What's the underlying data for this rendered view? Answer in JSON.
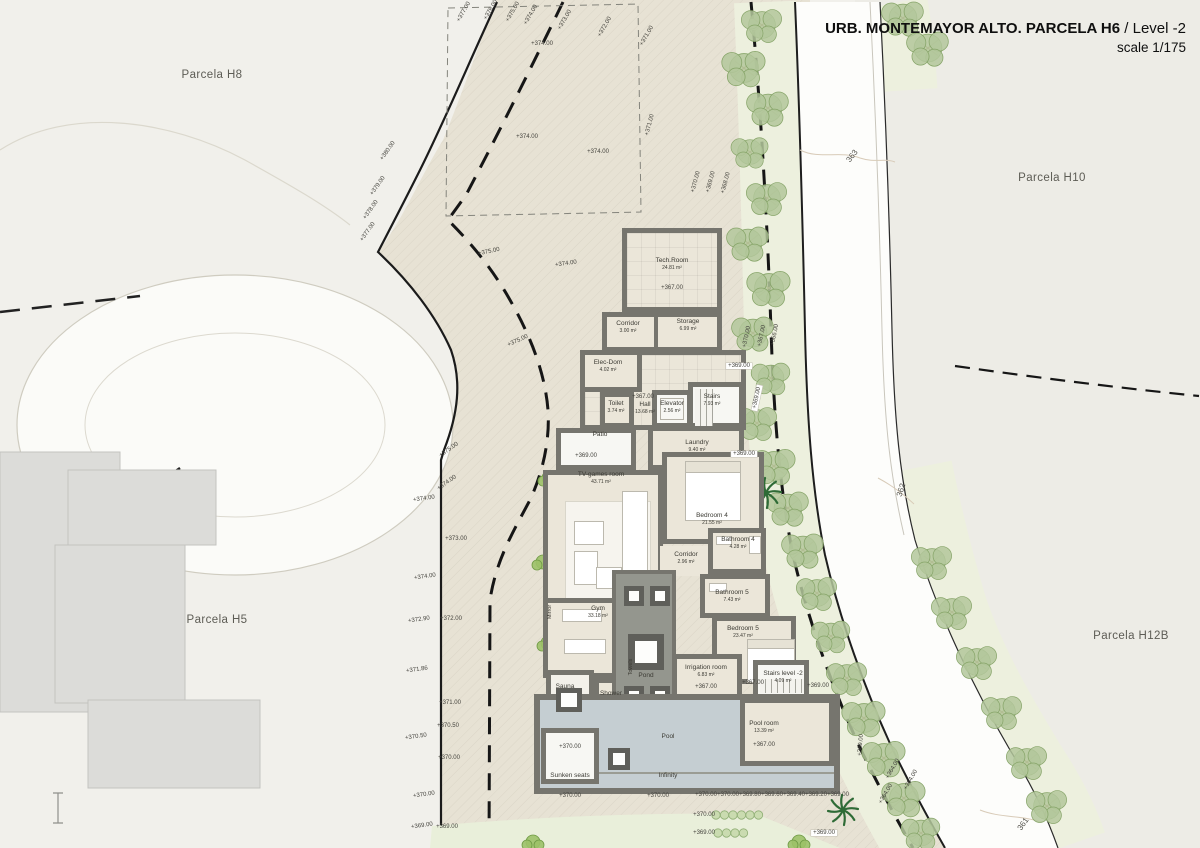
{
  "title": {
    "main": "URB. MONTEMAYOR ALTO. PARCELA H6",
    "sep": " / ",
    "level": "Level -2",
    "scale": "scale 1/175"
  },
  "parcels": [
    {
      "label": "Parcela H8",
      "x": 212,
      "y": 75
    },
    {
      "label": "Parcela H10",
      "x": 1052,
      "y": 178
    },
    {
      "label": "Parcela H5",
      "x": 217,
      "y": 620
    },
    {
      "label": "Parcela H12B",
      "x": 1131,
      "y": 636
    }
  ],
  "contours": [
    {
      "label": "363",
      "x": 852,
      "y": 156,
      "r": -52
    },
    {
      "label": "362",
      "x": 901,
      "y": 490,
      "r": -72
    },
    {
      "label": "361",
      "x": 1023,
      "y": 824,
      "r": -55
    }
  ],
  "rooms": [
    {
      "name": "Tech.Room",
      "area": "24.81 m²",
      "x": 672,
      "y": 264
    },
    {
      "name": "Corridor",
      "area": "3.00 m²",
      "x": 628,
      "y": 327
    },
    {
      "name": "Storage",
      "area": "6.99 m²",
      "x": 688,
      "y": 325
    },
    {
      "name": "Elec-Dom",
      "area": "4.02 m²",
      "x": 608,
      "y": 366
    },
    {
      "name": "Elevator",
      "area": "2.56 m²",
      "x": 672,
      "y": 407
    },
    {
      "name": "Toilet",
      "area": "3.74 m²",
      "x": 616,
      "y": 407
    },
    {
      "name": "Hall",
      "area": "13.68 m²",
      "x": 645,
      "y": 408
    },
    {
      "name": "Stairs",
      "area": "7.93 m²",
      "x": 712,
      "y": 400
    },
    {
      "name": "Laundry",
      "area": "9.40 m²",
      "x": 697,
      "y": 446
    },
    {
      "name": "Patio",
      "area": "",
      "x": 600,
      "y": 435
    },
    {
      "name": "TV-games room",
      "area": "43.71 m²",
      "x": 601,
      "y": 478
    },
    {
      "name": "Bedroom 4",
      "area": "21.55 m²",
      "x": 712,
      "y": 519
    },
    {
      "name": "Bathroom 4",
      "area": "4.28 m²",
      "x": 738,
      "y": 543
    },
    {
      "name": "Corridor",
      "area": "2.96 m²",
      "x": 686,
      "y": 558
    },
    {
      "name": "Bathroom 5",
      "area": "7.43 m²",
      "x": 732,
      "y": 596
    },
    {
      "name": "Bedroom 5",
      "area": "23.47 m²",
      "x": 743,
      "y": 632
    },
    {
      "name": "Gym",
      "area": "33.18 m²",
      "x": 598,
      "y": 612
    },
    {
      "name": "Sauna",
      "area": "",
      "x": 565,
      "y": 687
    },
    {
      "name": "Shower",
      "area": "",
      "x": 611,
      "y": 694
    },
    {
      "name": "Pond",
      "area": "",
      "x": 646,
      "y": 676
    },
    {
      "name": "Irrigation room",
      "area": "6.83 m²",
      "x": 706,
      "y": 671
    },
    {
      "name": "Stairs level -2",
      "area": "4.09 m²",
      "x": 783,
      "y": 677
    },
    {
      "name": "Pool",
      "area": "",
      "x": 668,
      "y": 737
    },
    {
      "name": "Pool room",
      "area": "13.39 m²",
      "x": 764,
      "y": 727
    },
    {
      "name": "Sunken seats",
      "area": "",
      "x": 570,
      "y": 776
    },
    {
      "name": "Infinity",
      "area": "",
      "x": 668,
      "y": 776
    }
  ],
  "vertical_labels": [
    {
      "t": "Mirror",
      "x": 550,
      "y": 612
    },
    {
      "t": "Towels",
      "x": 631,
      "y": 667
    }
  ],
  "elevations": [
    {
      "t": "+380.00",
      "x": 388,
      "y": 151,
      "r": -55
    },
    {
      "t": "+379.00",
      "x": 378,
      "y": 186,
      "r": -55
    },
    {
      "t": "+378.00",
      "x": 371,
      "y": 210,
      "r": -55
    },
    {
      "t": "+377.00",
      "x": 368,
      "y": 232,
      "r": -55
    },
    {
      "t": "+377.00",
      "x": 464,
      "y": 12,
      "r": -60
    },
    {
      "t": "+376.00",
      "x": 491,
      "y": 10,
      "r": -60
    },
    {
      "t": "+375.00",
      "x": 513,
      "y": 12,
      "r": -60
    },
    {
      "t": "+374.00",
      "x": 531,
      "y": 15,
      "r": -60
    },
    {
      "t": "+373.00",
      "x": 565,
      "y": 20,
      "r": -60
    },
    {
      "t": "+372.00",
      "x": 605,
      "y": 27,
      "r": -60
    },
    {
      "t": "+371.00",
      "x": 647,
      "y": 36,
      "r": -60
    },
    {
      "t": "+374.00",
      "x": 542,
      "y": 44,
      "r": 0
    },
    {
      "t": "+374.00",
      "x": 527,
      "y": 137,
      "r": 0
    },
    {
      "t": "+374.00",
      "x": 598,
      "y": 152,
      "r": 0
    },
    {
      "t": "+371.00",
      "x": 650,
      "y": 125,
      "r": -75
    },
    {
      "t": "+370.00",
      "x": 696,
      "y": 182,
      "r": -75
    },
    {
      "t": "+369.00",
      "x": 711,
      "y": 182,
      "r": -75
    },
    {
      "t": "+368.00",
      "x": 726,
      "y": 183,
      "r": -75
    },
    {
      "t": "+375.00",
      "x": 489,
      "y": 252,
      "r": -12
    },
    {
      "t": "+374.00",
      "x": 566,
      "y": 264,
      "r": -8
    },
    {
      "t": "+375.00",
      "x": 518,
      "y": 341,
      "r": -25
    },
    {
      "t": "+375.00",
      "x": 449,
      "y": 450,
      "r": -35
    },
    {
      "t": "+374.00",
      "x": 447,
      "y": 483,
      "r": -35
    },
    {
      "t": "+374.00",
      "x": 424,
      "y": 499,
      "r": -8
    },
    {
      "t": "+374.00",
      "x": 425,
      "y": 577,
      "r": -8
    },
    {
      "t": "+372.90",
      "x": 419,
      "y": 620,
      "r": -8
    },
    {
      "t": "+371.86",
      "x": 417,
      "y": 670,
      "r": -8
    },
    {
      "t": "+370.50",
      "x": 416,
      "y": 737,
      "r": -8
    },
    {
      "t": "+370.00",
      "x": 424,
      "y": 795,
      "r": -8
    },
    {
      "t": "+369.00",
      "x": 422,
      "y": 826,
      "r": -8
    },
    {
      "t": "+373.00",
      "x": 456,
      "y": 539,
      "r": 0
    },
    {
      "t": "+372.00",
      "x": 451,
      "y": 619,
      "r": 0
    },
    {
      "t": "+371.00",
      "x": 450,
      "y": 703,
      "r": 0
    },
    {
      "t": "+370.50",
      "x": 448,
      "y": 726,
      "r": 0
    },
    {
      "t": "+370.00",
      "x": 449,
      "y": 758,
      "r": 0
    },
    {
      "t": "+369.00",
      "x": 447,
      "y": 827,
      "r": 0
    },
    {
      "t": "+370.00",
      "x": 747,
      "y": 337,
      "r": -78
    },
    {
      "t": "+367.00",
      "x": 762,
      "y": 336,
      "r": -78
    },
    {
      "t": "+366.00",
      "x": 775,
      "y": 335,
      "r": -78
    },
    {
      "t": "+369.00",
      "x": 757,
      "y": 398,
      "r": -78,
      "box": true
    },
    {
      "t": "+369.00",
      "x": 739,
      "y": 366,
      "r": 0,
      "box": true
    },
    {
      "t": "+369.00",
      "x": 744,
      "y": 454,
      "r": 0,
      "box": true
    },
    {
      "t": "+367.00",
      "x": 672,
      "y": 288,
      "r": 0
    },
    {
      "t": "+367.00",
      "x": 643,
      "y": 397,
      "r": 0
    },
    {
      "t": "+369.00",
      "x": 586,
      "y": 456,
      "r": 0
    },
    {
      "t": "+367.00",
      "x": 706,
      "y": 687,
      "r": 0
    },
    {
      "t": "+367.00",
      "x": 753,
      "y": 683,
      "r": 0
    },
    {
      "t": "+369.00",
      "x": 818,
      "y": 686,
      "r": 0
    },
    {
      "t": "+367.00",
      "x": 764,
      "y": 745,
      "r": 0
    },
    {
      "t": "+370.00",
      "x": 570,
      "y": 747,
      "r": 0
    },
    {
      "t": "+369.00",
      "x": 861,
      "y": 745,
      "r": -85
    },
    {
      "t": "+370.00",
      "x": 570,
      "y": 796,
      "r": 0
    },
    {
      "t": "+370.00",
      "x": 658,
      "y": 796,
      "r": 0
    },
    {
      "t": "+370.00",
      "x": 706,
      "y": 795,
      "r": 0
    },
    {
      "t": "+370.00",
      "x": 728,
      "y": 795,
      "r": 0
    },
    {
      "t": "+369.80",
      "x": 750,
      "y": 795,
      "r": 0
    },
    {
      "t": "+369.60",
      "x": 772,
      "y": 795,
      "r": 0
    },
    {
      "t": "+369.40",
      "x": 794,
      "y": 795,
      "r": 0
    },
    {
      "t": "+369.20",
      "x": 816,
      "y": 795,
      "r": 0
    },
    {
      "t": "+369.00",
      "x": 838,
      "y": 795,
      "r": 0
    },
    {
      "t": "+370.00",
      "x": 704,
      "y": 815,
      "r": 0
    },
    {
      "t": "+369.00",
      "x": 704,
      "y": 833,
      "r": 0
    },
    {
      "t": "+369.00",
      "x": 824,
      "y": 833,
      "r": 0,
      "box": true
    },
    {
      "t": "+364.00",
      "x": 893,
      "y": 769,
      "r": -60
    },
    {
      "t": "+364.00",
      "x": 911,
      "y": 780,
      "r": -60
    },
    {
      "t": "+364.00",
      "x": 886,
      "y": 794,
      "r": -60
    }
  ],
  "trees": {
    "round": [
      [
        762,
        25
      ],
      [
        744,
        68
      ],
      [
        768,
        108
      ],
      [
        750,
        152
      ],
      [
        767,
        198
      ],
      [
        748,
        243
      ],
      [
        769,
        288
      ],
      [
        753,
        333
      ],
      [
        771,
        378
      ],
      [
        757,
        423
      ],
      [
        774,
        466
      ],
      [
        788,
        508
      ],
      [
        803,
        550
      ],
      [
        817,
        593
      ],
      [
        831,
        636
      ],
      [
        847,
        678
      ],
      [
        864,
        718
      ],
      [
        884,
        758
      ],
      [
        904,
        798
      ],
      [
        921,
        833
      ],
      [
        903,
        18
      ],
      [
        928,
        48
      ],
      [
        932,
        562
      ],
      [
        952,
        612
      ],
      [
        977,
        662
      ],
      [
        1002,
        712
      ],
      [
        1027,
        762
      ],
      [
        1047,
        806
      ]
    ],
    "patio": [
      598,
      446
    ],
    "palms": [
      [
        716,
        396
      ],
      [
        766,
        493
      ],
      [
        843,
        810
      ]
    ],
    "bushes": [
      [
        549,
        478
      ],
      [
        543,
        562
      ],
      [
        548,
        643
      ],
      [
        533,
        842
      ],
      [
        799,
        842
      ]
    ],
    "hedge_column": {
      "x": 830,
      "y0": 705,
      "dy": 10.5,
      "n": 9,
      "r": 5
    },
    "hedge_rows": [
      {
        "x0": 716,
        "y": 815,
        "dx": 8.5,
        "n": 6,
        "r": 4.2
      },
      {
        "x0": 718,
        "y": 833,
        "dx": 8.5,
        "n": 4,
        "r": 4.2
      }
    ]
  },
  "colors": {
    "wall_gray": "#76756e",
    "room_fill": "#ebe6d9",
    "pool_blue": "#c5ced2",
    "pond_gray": "#94968e",
    "parcel_beige": "#e7e2d4",
    "road_white": "#fdfdfb",
    "veg_green": "#edf0de",
    "tree_green": "#b3c79b",
    "bg_left": "#f1f0eb",
    "bg_right": "#edece6",
    "grass_green": "#e9efda"
  }
}
